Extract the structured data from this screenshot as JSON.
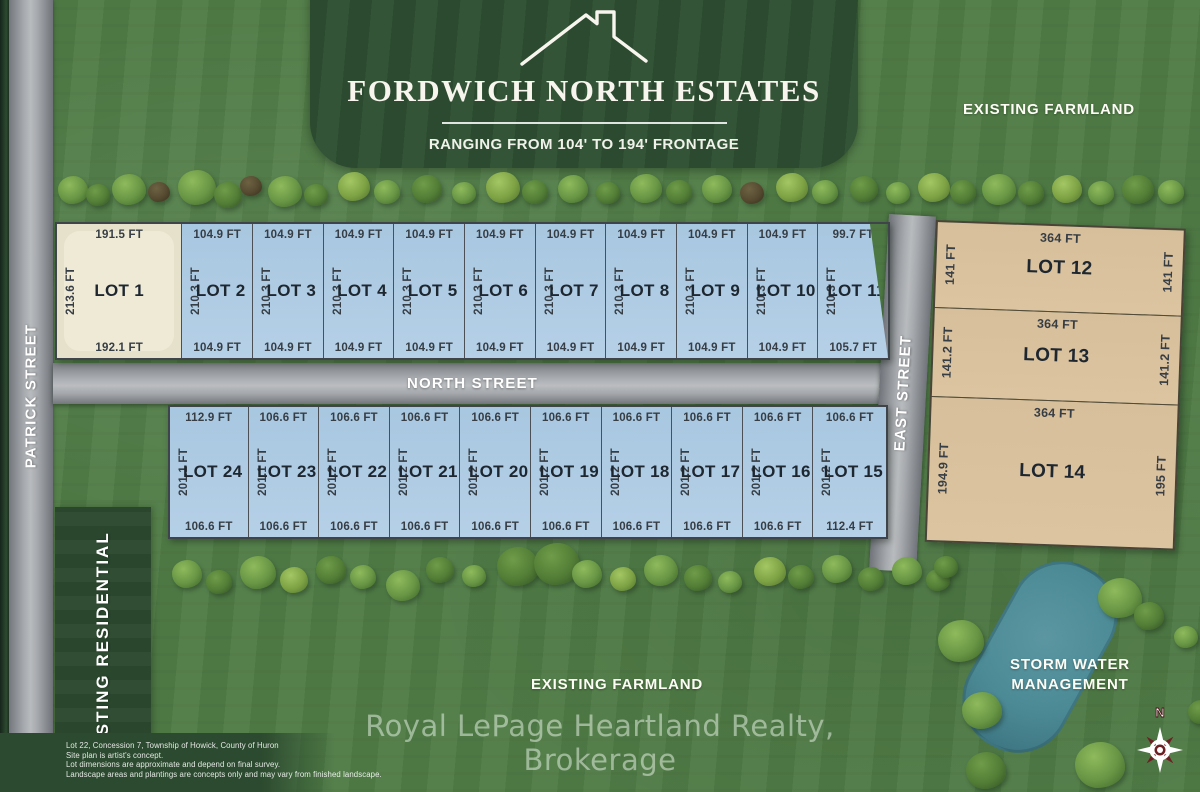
{
  "header": {
    "title": "FORDWICH NORTH ESTATES",
    "subtitle": "RANGING FROM 104' TO 194' FRONTAGE"
  },
  "area_labels": {
    "farmland_top": "EXISTING FARMLAND",
    "farmland_bottom": "EXISTING FARMLAND",
    "residential": "EXISTING RESIDENTIAL",
    "storm_line1": "STORM WATER",
    "storm_line2": "MANAGEMENT"
  },
  "streets": {
    "patrick": "PATRICK STREET",
    "north": "NORTH STREET",
    "east": "EAST STREET"
  },
  "compass": {
    "north_label": "N"
  },
  "watermark": "Royal LePage Heartland Realty, Brokerage",
  "disclaimer": [
    "Lot 22, Concession 7, Township of Howick, County of Huron",
    "Site plan is artist's concept.",
    "Lot dimensions are approximate and depend on final survey.",
    "Landscape areas and plantings are concepts only and may vary from finished landscape."
  ],
  "lots": {
    "top_row": [
      {
        "name": "LOT 1",
        "top": "191.5 FT",
        "side": "213.6 FT",
        "bottom": "192.1 FT",
        "fill": "cream"
      },
      {
        "name": "LOT 2",
        "top": "104.9 FT",
        "side": "210.3 FT",
        "bottom": "104.9 FT",
        "fill": "blue"
      },
      {
        "name": "LOT 3",
        "top": "104.9 FT",
        "side": "210.3 FT",
        "bottom": "104.9 FT",
        "fill": "blue"
      },
      {
        "name": "LOT 4",
        "top": "104.9 FT",
        "side": "210.3 FT",
        "bottom": "104.9 FT",
        "fill": "blue"
      },
      {
        "name": "LOT 5",
        "top": "104.9 FT",
        "side": "210.3 FT",
        "bottom": "104.9 FT",
        "fill": "blue"
      },
      {
        "name": "LOT 6",
        "top": "104.9 FT",
        "side": "210.3 FT",
        "bottom": "104.9 FT",
        "fill": "blue"
      },
      {
        "name": "LOT 7",
        "top": "104.9 FT",
        "side": "210.3 FT",
        "bottom": "104.9 FT",
        "fill": "blue"
      },
      {
        "name": "LOT 8",
        "top": "104.9 FT",
        "side": "210.3 FT",
        "bottom": "104.9 FT",
        "fill": "blue"
      },
      {
        "name": "LOT 9",
        "top": "104.9 FT",
        "side": "210.3 FT",
        "bottom": "104.9 FT",
        "fill": "blue"
      },
      {
        "name": "LOT 10",
        "top": "104.9 FT",
        "side": "210.3 FT",
        "bottom": "104.9 FT",
        "fill": "blue"
      },
      {
        "name": "LOT 11",
        "top": "99.7 FT",
        "side": "210.3 FT",
        "bottom": "105.7 FT",
        "fill": "blue"
      }
    ],
    "bottom_row": [
      {
        "name": "LOT 24",
        "top": "112.9 FT",
        "side": "201.1 FT",
        "bottom": "106.6 FT",
        "fill": "blue"
      },
      {
        "name": "LOT 23",
        "top": "106.6 FT",
        "side": "201.1 FT",
        "bottom": "106.6 FT",
        "fill": "blue"
      },
      {
        "name": "LOT 22",
        "top": "106.6 FT",
        "side": "201.2 FT",
        "bottom": "106.6 FT",
        "fill": "blue"
      },
      {
        "name": "LOT 21",
        "top": "106.6 FT",
        "side": "201.2 FT",
        "bottom": "106.6 FT",
        "fill": "blue"
      },
      {
        "name": "LOT 20",
        "top": "106.6 FT",
        "side": "201.2 FT",
        "bottom": "106.6 FT",
        "fill": "blue"
      },
      {
        "name": "LOT 19",
        "top": "106.6 FT",
        "side": "201.2 FT",
        "bottom": "106.6 FT",
        "fill": "blue"
      },
      {
        "name": "LOT 18",
        "top": "106.6 FT",
        "side": "201.2 FT",
        "bottom": "106.6 FT",
        "fill": "blue"
      },
      {
        "name": "LOT 17",
        "top": "106.6 FT",
        "side": "201.2 FT",
        "bottom": "106.6 FT",
        "fill": "blue"
      },
      {
        "name": "LOT 16",
        "top": "106.6 FT",
        "side": "201.2 FT",
        "bottom": "106.6 FT",
        "fill": "blue"
      },
      {
        "name": "LOT 15",
        "top": "106.6 FT",
        "side": "201.2 FT",
        "bottom": "112.4 FT",
        "fill": "blue"
      }
    ],
    "right_column": [
      {
        "name": "LOT 12",
        "top": "364 FT",
        "left": "141 FT",
        "right": "141 FT",
        "fill": "tan"
      },
      {
        "name": "LOT 13",
        "top": "364 FT",
        "left": "141.2 FT",
        "right": "141.2 FT",
        "fill": "tan"
      },
      {
        "name": "LOT 14",
        "top": "364 FT",
        "left": "194.9 FT",
        "right": "195 FT",
        "fill": "tan"
      }
    ]
  },
  "colors": {
    "grass": "#507c46",
    "dark_green": "#2d4e31",
    "street_gray": "#a6a9ad",
    "lot_blue": "#aecbe4",
    "lot_cream": "#ebe6d2",
    "lot_tan": "#dac09c",
    "pond_teal": "#4c8b96",
    "compass_red": "#6d2024"
  }
}
